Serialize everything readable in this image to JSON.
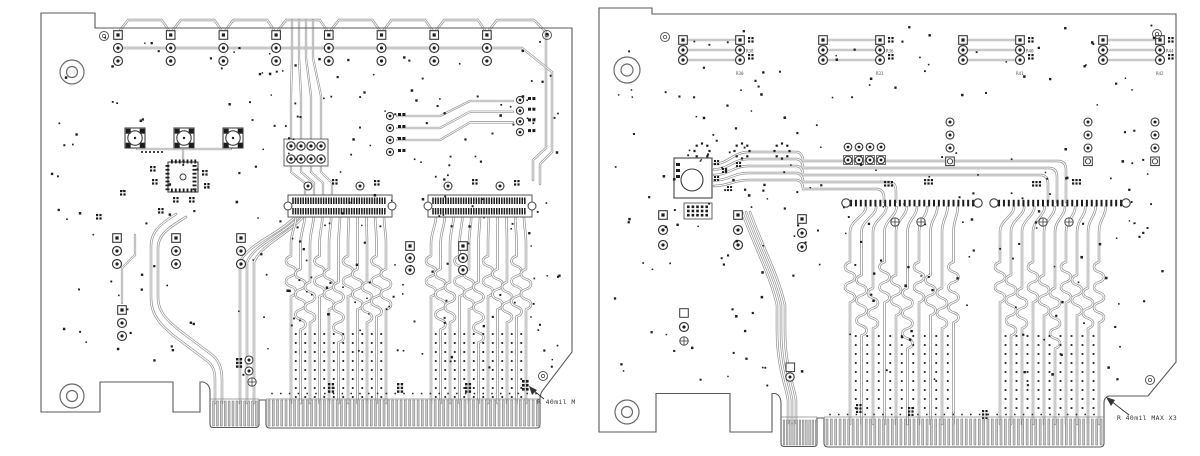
{
  "document": {
    "description": "PCB copper layer artwork plots, two PCIe add-in cards side by side",
    "background": "#ffffff"
  },
  "colors": {
    "outline": "#5a5a5a",
    "trace_outer": "#909090",
    "trace_inner": "#ffffff",
    "pad_dark": "#1c1c1c",
    "ring_stroke": "#3a3a3a",
    "hole_stroke": "#6a6a6a",
    "finger_fill": "#c8c8c8",
    "finger_stroke": "#757575",
    "dot": "#1f1f1f",
    "annotation": "#333333",
    "label": "#555555"
  },
  "annotations": {
    "left_note": "R 40mil M",
    "right_note": "R 40mil MAX X3"
  },
  "left_board": {
    "top_connector_count": 8,
    "can_component_count": 3,
    "center_connector_count": 2,
    "serpentine_traces_per_bundle": 11,
    "edge_fingers_small": 12,
    "edge_fingers_long": 64,
    "dot_seed": 7,
    "dot_count": 180
  },
  "right_board": {
    "top_group_count": 4,
    "group_labels": [
      {
        "upper": "R38",
        "lower": "R30"
      },
      {
        "upper": "R36",
        "lower": "R31"
      },
      {
        "upper": "R40",
        "lower": "R41"
      },
      {
        "upper": "R44",
        "lower": "R42"
      }
    ],
    "serpentine_traces_per_bundle": 10,
    "edge_fingers_small": 11,
    "edge_fingers_long": 64,
    "dot_seed": 13,
    "dot_count": 180
  }
}
